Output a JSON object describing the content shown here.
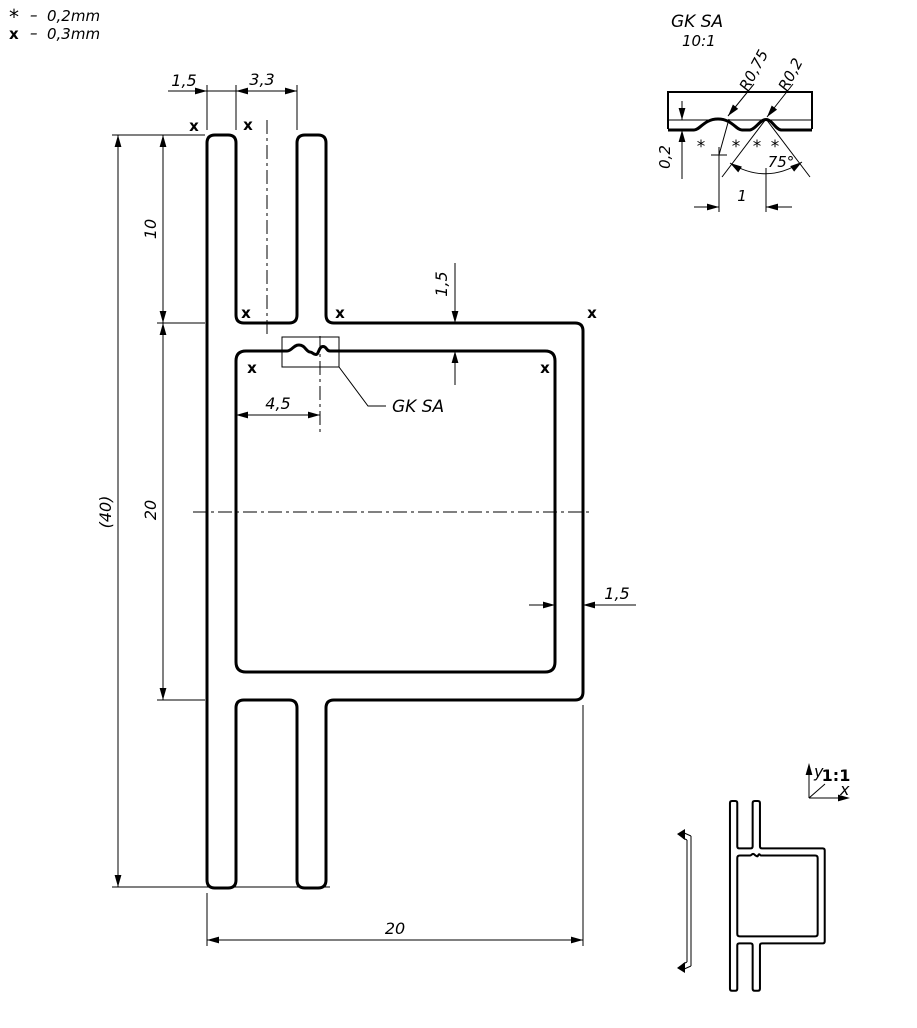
{
  "legend": {
    "rows": [
      {
        "symbol": "*",
        "dash": "–",
        "value": "0,2mm"
      },
      {
        "symbol": "x",
        "dash": "–",
        "value": "0,3mm"
      }
    ]
  },
  "main_view": {
    "detail_label": "GK SA",
    "corner_mark": "x",
    "dim_spine_thickness": "1,5",
    "dim_slot_width": "3,3",
    "dim_leg_height": "10",
    "dim_overall_height": "(40)",
    "dim_box_height": "20",
    "dim_top_wall": "1,5",
    "dim_right_wall": "1,5",
    "dim_detail_position": "4,5",
    "dim_overall_width": "20"
  },
  "detail_view": {
    "title": "GK SA",
    "scale": "10:1",
    "radius_large": "R0,75",
    "radius_small": "R0,2",
    "depth_dim": "0,2",
    "angle_dim": "75°",
    "pitch_dim": "1",
    "surface_mark": "*"
  },
  "mini_view": {
    "scale_label": "1:1",
    "axis_x_label": "x",
    "axis_y_label": "y"
  }
}
